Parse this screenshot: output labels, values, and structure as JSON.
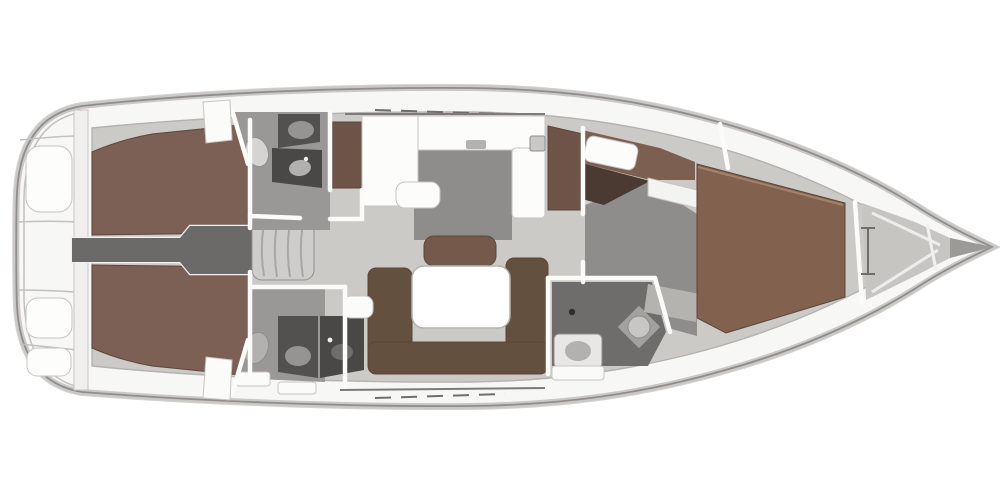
{
  "title": "Sailing yacht interior layout floor plan",
  "view": {
    "projection": "top-down",
    "bow_direction": "right",
    "visible_text": ""
  },
  "colors": {
    "background": "#ffffff",
    "deck": "#f7f7f6",
    "floor": "#cbcac7",
    "floor_dark": "#8f8d8b",
    "floor_mid": "#9a9896",
    "rug": "#b4b3b0",
    "corridor": "#6c6a68",
    "panel_dark": "#535150",
    "panel_darker": "#4a4846",
    "wood": "#7d6055",
    "wood_fwd": "#82614f",
    "wood_band": "#7c5f50",
    "wood_dark": "#4b3a31",
    "sofa": "#64503f",
    "bench": "#75594a",
    "cabinet": "#6e5448",
    "table": "#ffffff",
    "wall": "#fbfbfa",
    "steps": "#cecdcb",
    "locker": "#c6c5c2",
    "bow_tip": "#9b9a97",
    "fixture_light": "#d5d4d2",
    "fixture_mid": "#b2b1af",
    "fixture_gray": "#969492",
    "sink_light": "#c7c6c4",
    "seat_pad": "#fdfdfc",
    "hatch": "#fcfcfb"
  },
  "regions": {
    "stern": "swim platform and transom seats",
    "aft_cabin_top": "aft double cabin (top)",
    "aft_cabin_bottom": "aft double cabin (bottom)",
    "corridor": "companionway corridor and steps",
    "head_top": "aft head with shower (top)",
    "head_bottom": "aft head with shower (bottom)",
    "wardrobe": "wardrobe locker",
    "galley": "U-shaped galley",
    "salon": "salon with U-sofa and table",
    "fwd_head": "forward head",
    "fwd_cabin": "forward cabin with island berth",
    "bow": "anchor locker and bow"
  }
}
